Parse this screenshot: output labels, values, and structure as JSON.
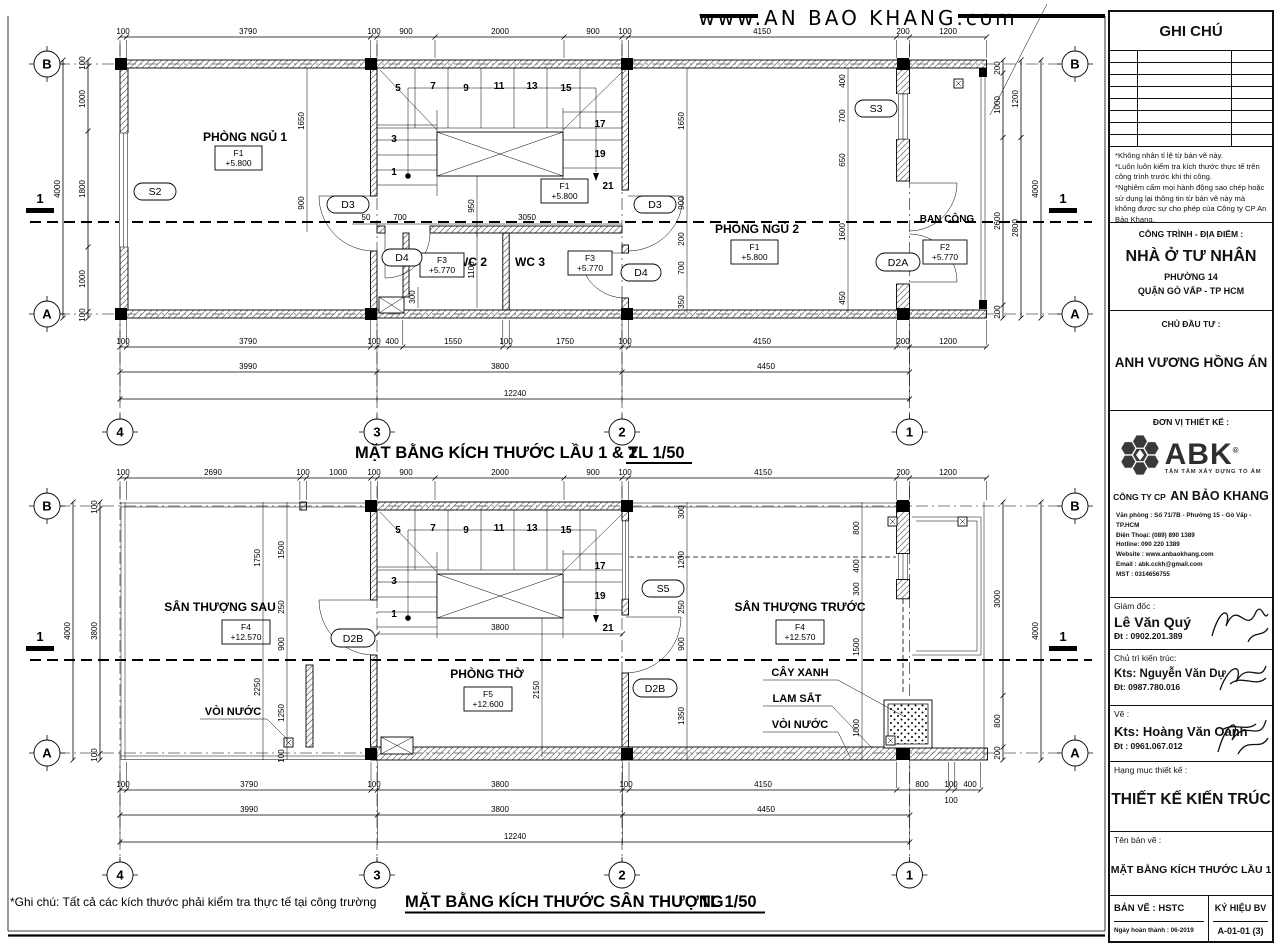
{
  "header": {
    "website": "www.AN BAO KHANG.com"
  },
  "shared": {
    "stair_numbers": [
      "5",
      "7",
      "9",
      "11",
      "13",
      "15",
      "17",
      "19",
      "21",
      "3",
      "1"
    ],
    "grid_cols": [
      "4",
      "3",
      "2",
      "1"
    ],
    "grid_rows": {
      "top": "B",
      "bottom": "A"
    },
    "section_mark": "1"
  },
  "plan1": {
    "title": "MẶT BẰNG KÍCH THƯỚC LẦU 1 & 2",
    "scale": "TL 1/50",
    "rooms": {
      "bedroom1": {
        "name": "PHÒNG NGỦ 1",
        "tag": "F1",
        "level": "+5.800"
      },
      "bedroom2": {
        "name": "PHÒNG NGỦ 2",
        "tag": "F1",
        "level": "+5.800"
      },
      "stair": {
        "tag": "F1",
        "level": "+5.800"
      },
      "wc2": {
        "name": "WC 2",
        "tag": "F3",
        "level": "+5.770"
      },
      "wc3": {
        "name": "WC 3",
        "tag": "F3",
        "level": "+5.770"
      },
      "balcony": {
        "name": "BAN CÔNG",
        "tag": "F2",
        "level": "+5.770"
      }
    },
    "tags": {
      "s2": "S2",
      "s3": "S3",
      "d3": "D3",
      "d4": "D4",
      "d2a": "D2A"
    },
    "dims": {
      "top": [
        "100",
        "3790",
        "100",
        "900",
        "2000",
        "900",
        "100",
        "4150",
        "200",
        "1200"
      ],
      "bot1": [
        "100",
        "3790",
        "100",
        "400",
        "1550",
        "100",
        "1750",
        "100",
        "4150",
        "200",
        "1200"
      ],
      "bot2": [
        "3990",
        "3800",
        "4450"
      ],
      "total": "12240",
      "left": [
        "100",
        "1000",
        "1800",
        "1000",
        "100"
      ],
      "left_total": "4000",
      "right_in": [
        "200",
        "1000",
        "2600",
        "200"
      ],
      "right_mid": [
        "1200",
        "2800"
      ],
      "right_total": "4000",
      "bed1": [
        "1650",
        "900"
      ],
      "bed2": [
        "1650",
        "900",
        "200",
        "700",
        "350"
      ],
      "front": [
        "400",
        "700",
        "650",
        "1600",
        "450"
      ],
      "stair": [
        "950",
        "1100",
        "300",
        "50",
        "700",
        "3050"
      ]
    }
  },
  "plan2": {
    "title": "MẶT BẰNG KÍCH THƯỚC SÂN THƯỢNG",
    "scale": "TL 1/50",
    "note": "*Ghi chú: Tất cả các kích thước phải kiểm tra thực tế tại công trường",
    "rooms": {
      "terrace_back": {
        "name": "SÂN THƯỢNG SAU",
        "tag": "F4",
        "level": "+12.570"
      },
      "worship": {
        "name": "PHÒNG THỜ",
        "tag": "F5",
        "level": "+12.600"
      },
      "terrace_front": {
        "name": "SÂN THƯỢNG TRƯỚC",
        "tag": "F4",
        "level": "+12.570"
      }
    },
    "labels": {
      "faucet_left": "VÒI NƯỚC",
      "tree": "CÂY XANH",
      "iron_louver": "LAM SẮT",
      "faucet_right": "VÒI NƯỚC"
    },
    "tags": {
      "s5": "S5",
      "d2b": "D2B"
    },
    "dims": {
      "top": [
        "100",
        "2690",
        "100",
        "1000",
        "100",
        "900",
        "2000",
        "900",
        "100",
        "4150",
        "200",
        "1200"
      ],
      "bot1": [
        "100",
        "3790",
        "100",
        "3800",
        "100",
        "4150",
        "800",
        "100",
        "400"
      ],
      "bot1_sub": "100",
      "bot2": [
        "3990",
        "3800",
        "4450"
      ],
      "total": "12240",
      "left": [
        "100",
        "3800",
        "100"
      ],
      "left_total": "4000",
      "left_in1": [
        "1750",
        "2250"
      ],
      "left_in2": [
        "1500",
        "250",
        "900",
        "1250",
        "100"
      ],
      "right_in1": [
        "300",
        "1200",
        "250",
        "900",
        "1350"
      ],
      "right_in2": [
        "800",
        "400",
        "300",
        "1500",
        "1000"
      ],
      "right": [
        "3000",
        "800",
        "200"
      ],
      "right_total": "4000",
      "room": [
        "3800",
        "2150"
      ]
    }
  },
  "titleblock": {
    "ghi_chu": "GHI CHÚ",
    "notes": [
      "*Không nhân tỉ lệ từ bản vẽ này.",
      "*Luôn luôn kiểm tra kích thước thực tế trên công trình trước khi thi công.",
      "*Nghiêm cấm mọi hành động sao chép hoặc sử dụng lại thông tin từ bản vẽ này mà không được sự cho phép của Công ty CP An Bảo Khang."
    ],
    "cong_trinh": {
      "label": "CÔNG TRÌNH - ĐỊA ĐIỂM :",
      "name": "NHÀ Ở TƯ NHÂN",
      "line2": "PHƯỜNG 14",
      "line3": "QUẬN GÒ VẤP - TP HCM"
    },
    "chu_dau_tu": {
      "label": "CHỦ ĐẦU TƯ :",
      "name": "ANH VƯƠNG HỒNG ÁN"
    },
    "don_vi": {
      "label": "ĐƠN VỊ THIẾT KẾ :",
      "logo": "ABK",
      "tagline": "TẬN TÂM XÂY DỰNG TỔ ẤM",
      "company_prefix": "CÔNG TY CP",
      "company": "AN BẢO KHANG",
      "contact": [
        "Văn phòng : Số 71/7B - Phường 15 - Gò Vấp - TP.HCM",
        "Điện Thoại: (089) 890 1389",
        "Hotline: 090 220 1389",
        "Website : www.anbaokhang.com",
        "Email : abk.cckh@gmail.com",
        "MST : 0314656755"
      ]
    },
    "giam_doc": {
      "label": "Giám đốc :",
      "name": "Lê Văn Quý",
      "phone": "Đt : 0902.201.389"
    },
    "chu_tri": {
      "label": "Chủ trì kiến trúc:",
      "name": "Kts: Nguyễn Văn Dự",
      "phone": "Đt: 0987.780.016"
    },
    "ve": {
      "label": "Vẽ :",
      "name": "Kts: Hoàng Văn Oanh",
      "phone": "Đt : 0961.067.012"
    },
    "hang_muc": {
      "label": "Hạng mục thiết kế :",
      "value": "THIẾT KẾ KIẾN TRÚC"
    },
    "ten_ban_ve": {
      "label": "Tên bản vẽ :",
      "value": "MẶT BẰNG KÍCH THƯỚC LẦU 1"
    },
    "footer": {
      "ban_ve": "BẢN VẼ : HSTC",
      "ky_hieu": "KÝ HIỆU BV",
      "ngay": "Ngày hoàn thành : 06-2019",
      "code": "A-01-01 (3)"
    }
  }
}
